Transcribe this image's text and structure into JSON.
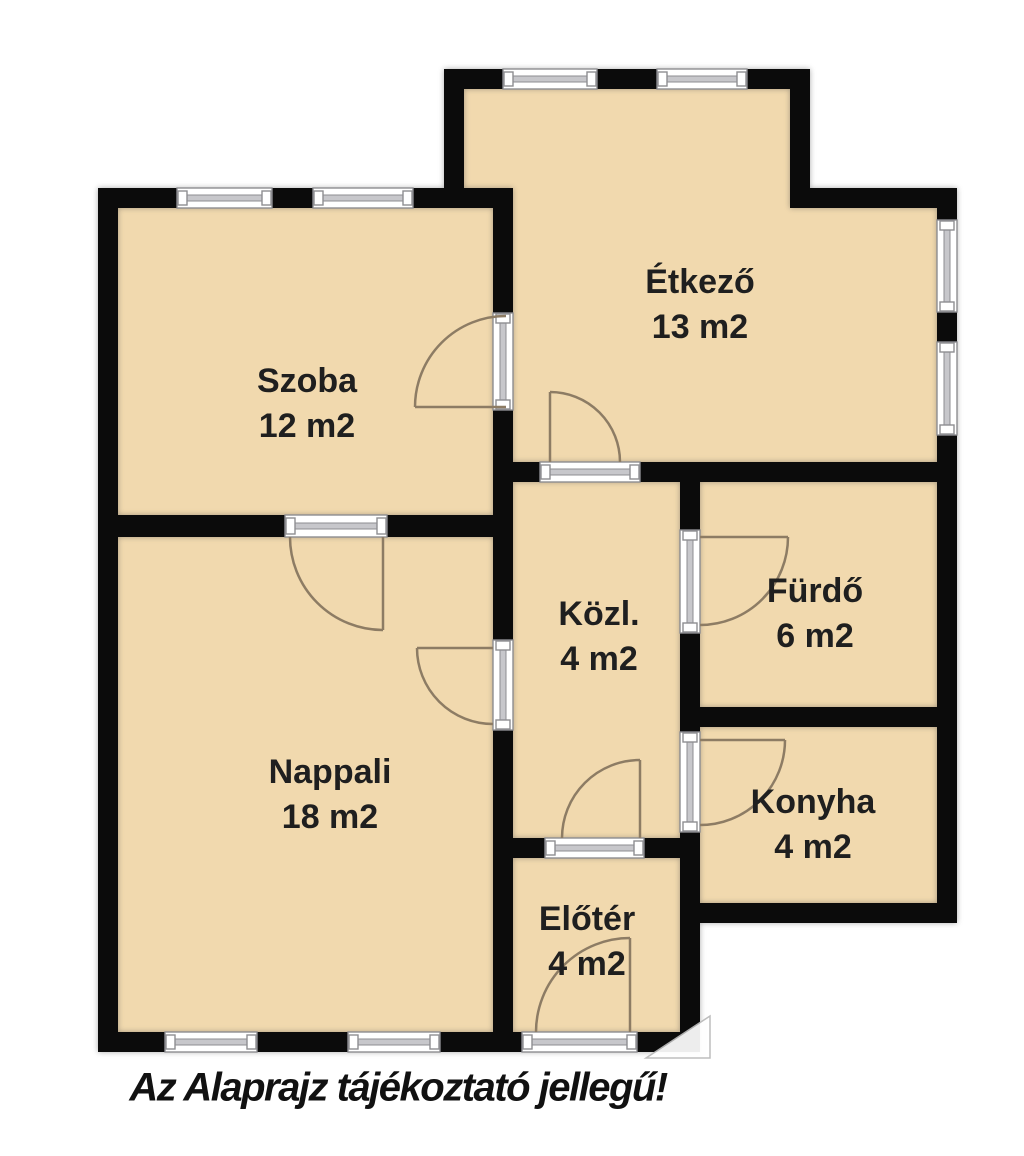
{
  "caption": "Az Alaprajz tájékoztató jellegű!",
  "rooms": [
    {
      "id": "szoba",
      "name": "Szoba",
      "area": "12 m2"
    },
    {
      "id": "etkezo",
      "name": "Étkező",
      "area": "13 m2"
    },
    {
      "id": "kozl",
      "name": "Közl.",
      "area": "4 m2"
    },
    {
      "id": "furdo",
      "name": "Fürdő",
      "area": "6 m2"
    },
    {
      "id": "konyha",
      "name": "Konyha",
      "area": "4 m2"
    },
    {
      "id": "nappali",
      "name": "Nappali",
      "area": "18 m2"
    },
    {
      "id": "eloter",
      "name": "Előtér",
      "area": "4 m2"
    }
  ],
  "colors": {
    "room_fill": "#f1d9ae",
    "wall": "#0b0b0b",
    "window_band": "#c7c7cb",
    "window_stroke": "#8e8e92",
    "door_arc": "#8d7c64",
    "text": "#1f1f1f"
  }
}
